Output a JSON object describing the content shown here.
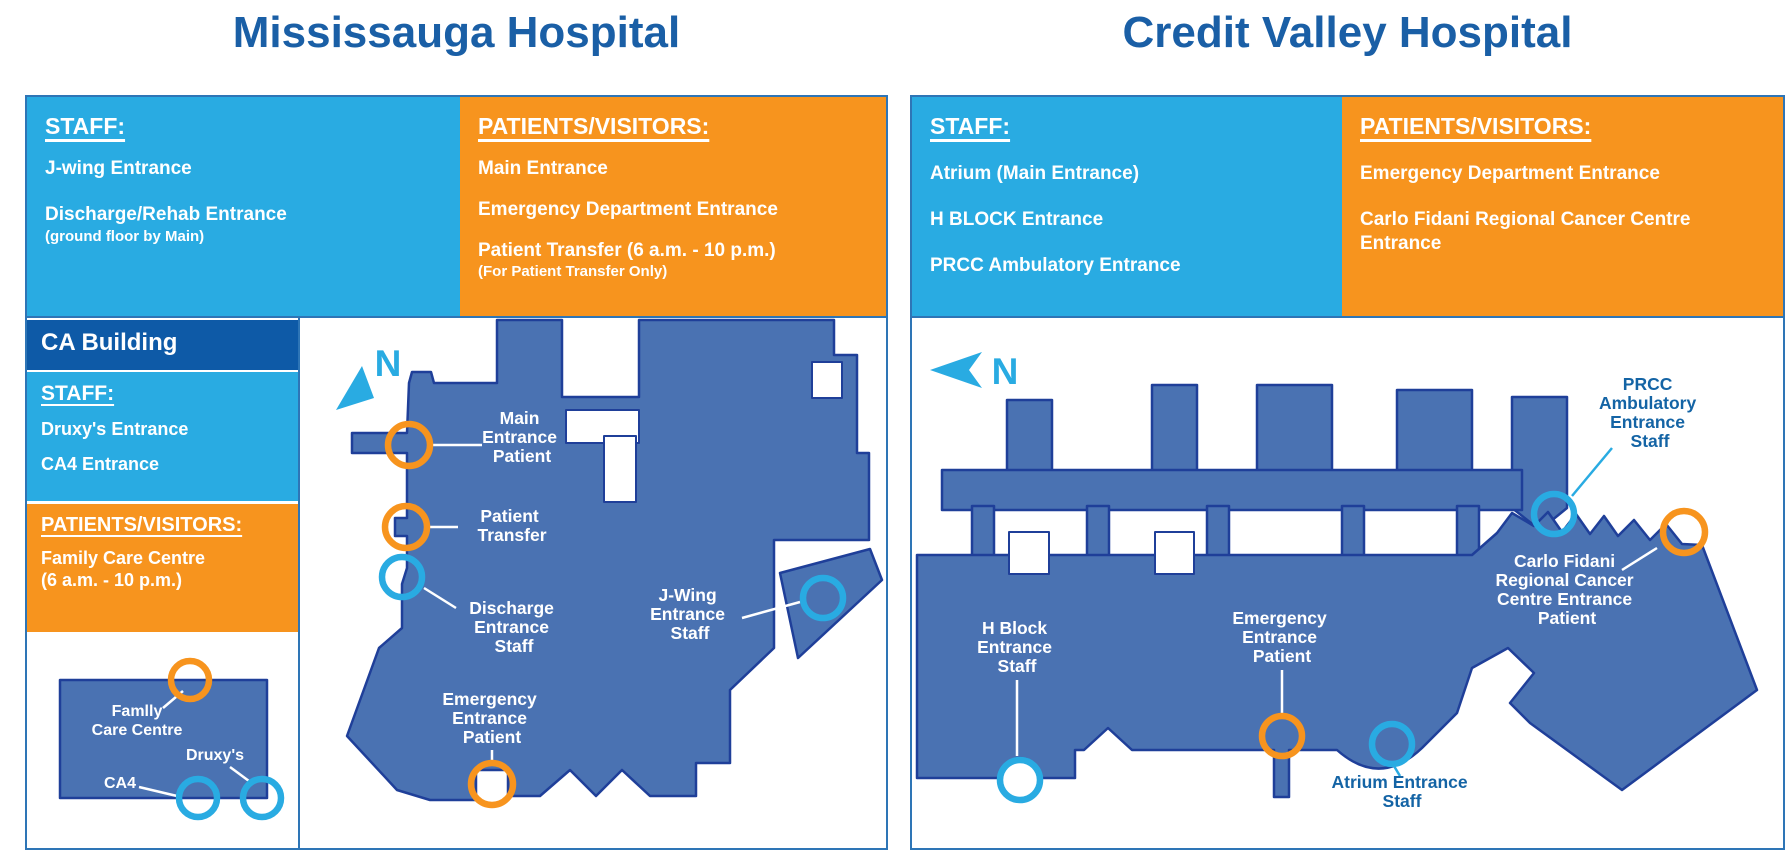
{
  "colors": {
    "cyan": "#29ABE2",
    "orange": "#F7941E",
    "navy_header": "#0E5AA7",
    "building_fill": "#4A72B2",
    "building_outline": "#1F3F99",
    "title_blue": "#1A5FA6",
    "label_blue": "#1464A5",
    "panel_border": "#2E75B6"
  },
  "left": {
    "title": "Mississauga Hospital",
    "compass": "N",
    "staff": {
      "heading": "STAFF:",
      "item1": "J-wing Entrance",
      "item2": "Discharge/Rehab Entrance",
      "item2_sub": "(ground floor by Main)"
    },
    "patients": {
      "heading": "PATIENTS/VISITORS:",
      "item1": "Main Entrance",
      "item2": "Emergency Department Entrance",
      "item3": "Patient Transfer (6 a.m. - 10 p.m.)",
      "item3_sub": "(For Patient Transfer Only)"
    },
    "ca": {
      "header": "CA Building",
      "staff": {
        "heading": "STAFF:",
        "item1": "Druxy's Entrance",
        "item2": "CA4 Entrance"
      },
      "patients": {
        "heading": "PATIENTS/VISITORS:",
        "item1": "Family Care Centre",
        "item1_sub": "(6 a.m. - 10 p.m.)"
      }
    },
    "minimap": {
      "family_line1": "Famlly",
      "family_line2": "Care Centre",
      "druxys": "Druxy's",
      "ca4": "CA4"
    },
    "map_labels": {
      "main": [
        "Main",
        "Entrance",
        "Patient"
      ],
      "transfer": [
        "Patient",
        "Transfer"
      ],
      "discharge": [
        "Discharge",
        "Entrance",
        "Staff"
      ],
      "jwing": [
        "J-Wing",
        "Entrance",
        "Staff"
      ],
      "emergency": [
        "Emergency",
        "Entrance",
        "Patient"
      ]
    }
  },
  "right": {
    "title": "Credit Valley Hospital",
    "compass": "N",
    "staff": {
      "heading": "STAFF:",
      "item1": "Atrium (Main Entrance)",
      "item2": "H BLOCK Entrance",
      "item3": "PRCC Ambulatory Entrance"
    },
    "patients": {
      "heading": "PATIENTS/VISITORS:",
      "item1": "Emergency Department Entrance",
      "item2": "Carlo Fidani Regional Cancer Centre Entrance"
    },
    "map_labels": {
      "hblock": [
        "H Block",
        "Entrance",
        "Staff"
      ],
      "emergency": [
        "Emergency",
        "Entrance",
        "Patient"
      ],
      "atrium": [
        "Atrium Entrance",
        "Staff"
      ],
      "prcc": [
        "PRCC",
        "Ambulatory",
        "Entrance",
        "Staff"
      ],
      "carlo": [
        "Carlo Fidani",
        "Regional Cancer",
        "Centre Entrance",
        "Patient"
      ]
    }
  }
}
